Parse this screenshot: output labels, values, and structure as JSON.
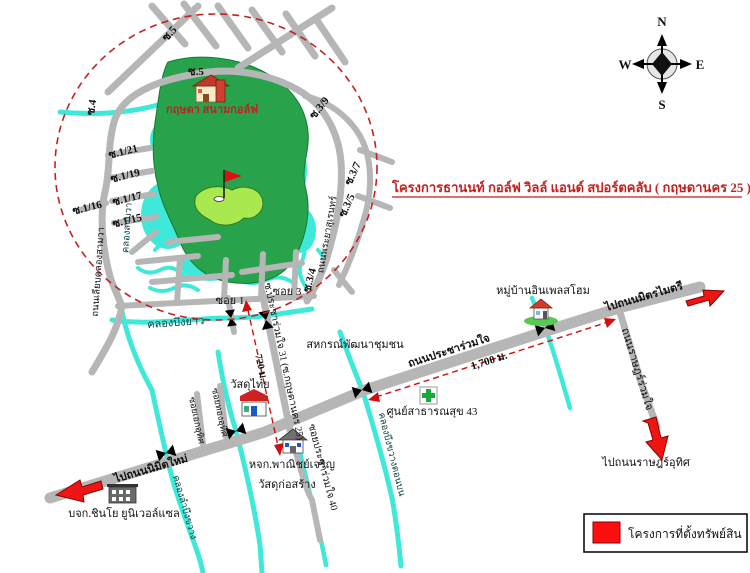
{
  "title": "โครงการธานนท์ กอล์ฟ วิลล์ แอนด์ สปอร์ตคลับ ( กฤษดานคร 25 )",
  "compass": {
    "n": "N",
    "w": "W",
    "e": "E",
    "s": "S"
  },
  "legend": {
    "label": "โครงการที่ตั้งทรัพย์สิน"
  },
  "places": {
    "clubhouse": "กฤษดา สนามกอล์ฟ",
    "sahakorn": "สหกรณ์พัฒนาชุมชน",
    "wasadu_thai": "วัสดุไทย",
    "panich_line1": "หจก.พาณิชย์เจริญ",
    "panich_line2": "วัสดุก่อสร้าง",
    "health_center": "ศูนย์สาธารณสุข 43",
    "village": "หมู่บ้านอินเพลสโฮม",
    "shinso": "บจก.ชินโย ยูนิเวอล์แซล"
  },
  "roads": {
    "soi5_diag": "ซ.5",
    "soi5_top": "ซ.5",
    "soi4": "ซ.4",
    "soi_1_21": "ซ.1/21",
    "soi_1_19": "ซ.1/19",
    "soi_1_17": "ซ.1/17",
    "soi_1_16": "ซ.1/16",
    "soi_1_15": "ซ.1/15",
    "soi_3_9": "ซ.3/9",
    "soi_3_7": "ซ.3/7",
    "soi_3_5": "ซ.3/5",
    "soi_3_4": "ซ.3/4",
    "left_ring_road": "ถนนเลียบคลองสามวา",
    "right_ring_road": "ถนนพระยาสุเรนทร์",
    "soi_1": "ซอย 1",
    "soi_3": "ซอย 3",
    "soi31": "ซ.ประชาร่วมใจ 31 (ซ.กฤษดานคร 25)",
    "soi40": "ซอยประชาร่วมใจ 40",
    "stub_soi_a": "ซอยเอกอุทิศ",
    "stub_soi_b": "ซอยทองอุทิศ",
    "main_road": "ถนนประชาร่วมใจ",
    "east_road": "ถนนราษฎร์ร่วมใจ",
    "to_nimitmai": "ไปถนนนิมิตใหม่",
    "to_mitmaitri": "ไปถนนมิตรไมตรี",
    "to_ratuthit": "ไปถนนราษฎร์อุทิศ"
  },
  "canals": {
    "khlong_samwa": "คลองสามวา",
    "khlong_buengyao": "คลองบึงยาว",
    "khlong_left": "คลองลำบึงขวาง",
    "khlong_right": "คลองบึงขวางตอนบน"
  },
  "distances": {
    "d720": "720 ม.",
    "d1700": "1,700 ม."
  },
  "colors": {
    "road": "#b6b6b6",
    "water": "#3fe9da",
    "golf_green": "#28a34c",
    "putting_green": "#a9e84e",
    "accent_red": "#e01010",
    "dashed_red": "#c22222"
  }
}
